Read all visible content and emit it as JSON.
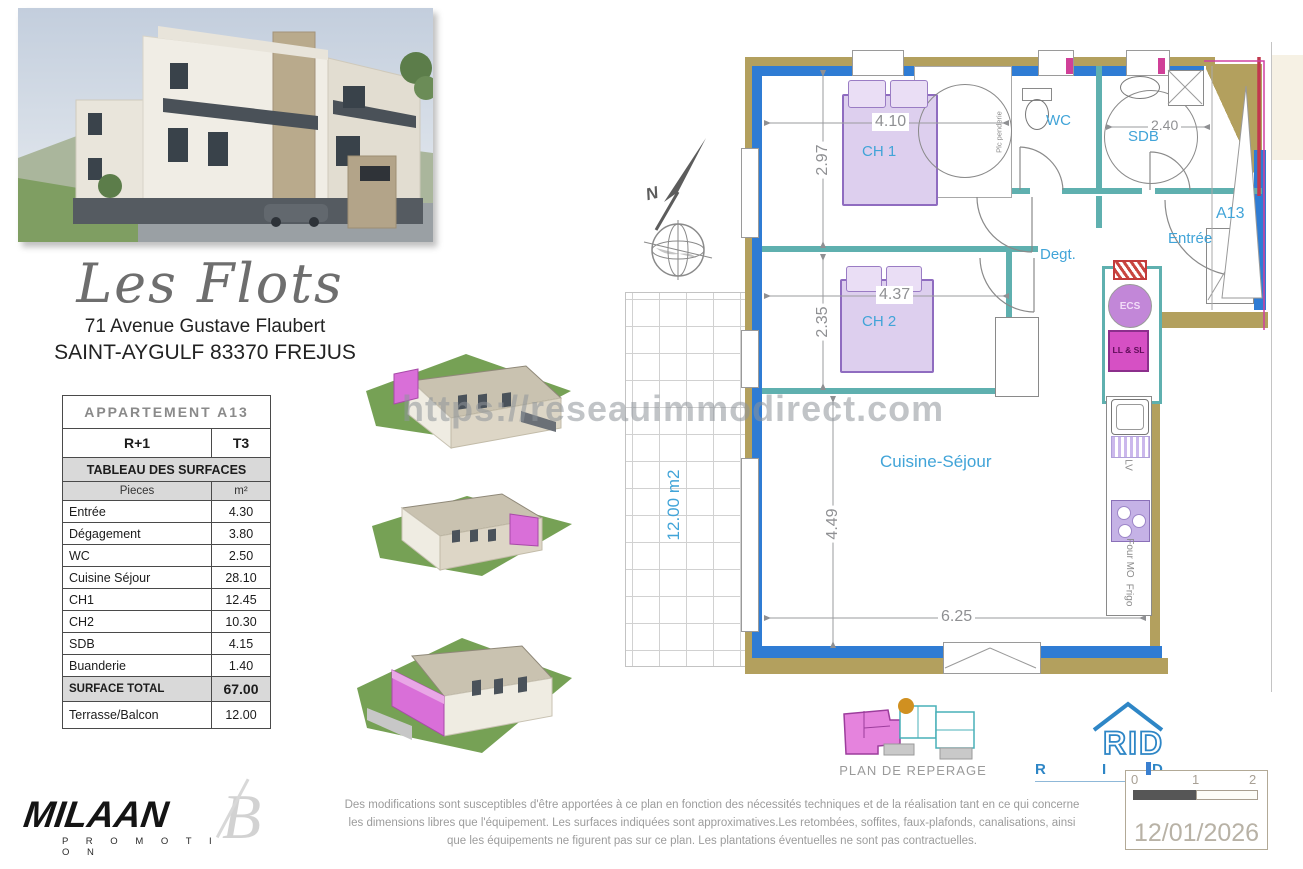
{
  "project": {
    "name": "Les Flots",
    "address_line1": "71 Avenue Gustave Flaubert",
    "address_line2": "SAINT-AYGULF 83370 FREJUS"
  },
  "surface_table": {
    "title": "APPARTEMENT A13",
    "floor": "R+1",
    "type_label": "T3",
    "section": "TABLEAU DES SURFACES",
    "col_room": "Pieces",
    "col_area": "m²",
    "rows": [
      {
        "label": "Entrée",
        "value": "4.30"
      },
      {
        "label": "Dégagement",
        "value": "3.80"
      },
      {
        "label": "WC",
        "value": "2.50"
      },
      {
        "label": "Cuisine Séjour",
        "value": "28.10"
      },
      {
        "label": "CH1",
        "value": "12.45"
      },
      {
        "label": "CH2",
        "value": "10.30"
      },
      {
        "label": "SDB",
        "value": "4.15"
      },
      {
        "label": "Buanderie",
        "value": "1.40"
      }
    ],
    "total_label": "SURFACE TOTAL",
    "total_value": "67.00",
    "terrace_label": "Terrasse/Balcon",
    "terrace_value": "12.00"
  },
  "floor_plan": {
    "compass": "N",
    "unit": "A13",
    "labels": {
      "ch1": "CH 1",
      "ch2": "CH 2",
      "wc": "WC",
      "sdb": "SDB",
      "entree": "Entrée",
      "degt": "Degt.",
      "cuisine": "Cuisine-Séjour",
      "terrace": "12.00 m2",
      "closet": "Plc penderie"
    },
    "dims": {
      "ch1_w": "4.10",
      "ch1_h": "2.97",
      "ch2_w": "4.37",
      "ch2_h": "2.35",
      "sdb_w": "2.40",
      "sejour_h": "4.49",
      "sejour_w": "6.25"
    },
    "appliances": {
      "ecs": "ECS",
      "llsl": "LL & SL",
      "lv": "LV",
      "four": "Four MO",
      "frigo": "Frigo"
    }
  },
  "watermark": "https://reseauimmodirect.com",
  "reperage_label": "PLAN DE REPERAGE",
  "branding": {
    "promoter": "MILAAN",
    "promoter_sub": "P R O M O T I O N",
    "rid": "RID",
    "rid_letters": [
      "R",
      "I",
      "D"
    ],
    "architect_mark": "B"
  },
  "footer": {
    "disclaimer_lines": [
      "Des modifications sont susceptibles d'être apportées à ce plan en fonction des nécessités techniques et de la réalisation tant en ce qui concerne",
      "les dimensions libres que l'équipement.  Les surfaces indiquées sont approximatives.Les retombées, soffites, faux-plafonds, canalisations, ainsi",
      "que les équipements ne figurent pas sur ce plan. Les plantations éventuelles ne sont pas contractuelles."
    ],
    "scale_ticks": [
      "0",
      "1",
      "2"
    ],
    "date": "12/01/2026"
  }
}
